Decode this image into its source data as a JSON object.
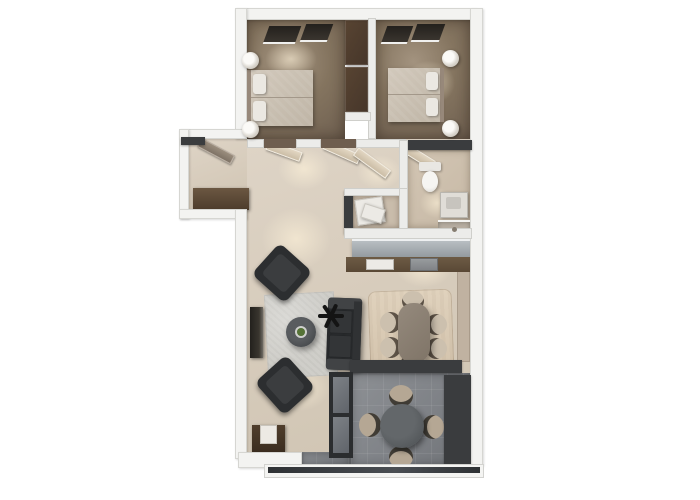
{
  "meta": {
    "description": "Top-down 3D rendered floor plan of a two-bedroom apartment with balcony",
    "background_color": "#ffffff",
    "visible_text": "none"
  },
  "palette": {
    "exterior_wall": "#f3f3f1",
    "dark_wall": "#3a3c3e",
    "bedroom_floor": "#84745f",
    "living_floor": "#d7ccbc",
    "bathroom_floor": "#c6b8a5",
    "balcony_floor": "#7f8287",
    "wardrobe_brown": "#46362a",
    "sofa_charcoal": "#27292b",
    "dining_rug": "#d3c3ac",
    "chair_tan": "#ccc0ae",
    "accent_plant_green": "#557336"
  },
  "rooms": {
    "bedroom1": {
      "label": "Bedroom 1 (left)"
    },
    "bedroom2": {
      "label": "Bedroom 2 (right)"
    },
    "hallway": {
      "label": "Hallway"
    },
    "entry": {
      "label": "Entry"
    },
    "bathroom": {
      "label": "Bathroom"
    },
    "storage": {
      "label": "Storage closet"
    },
    "kitchen": {
      "label": "Kitchen counter"
    },
    "living": {
      "label": "Living room"
    },
    "dining": {
      "label": "Dining area"
    },
    "balcony": {
      "label": "Balcony / terrace"
    }
  },
  "furniture": {
    "bedroom1": {
      "bed": "Double bed with two pillows",
      "lamps": "Two bedside lamps",
      "windows": "Two windows on top wall",
      "wardrobe": "Dark wardrobe column"
    },
    "bedroom2": {
      "bed": "Double bed with two pillows",
      "lamps": "Two bedside lamps",
      "windows": "Two windows on top wall"
    },
    "bathroom": {
      "toilet": "Toilet",
      "vanity": "Washbasin vanity",
      "shower": "Corner shower"
    },
    "storage": {
      "appliance": "White appliance / shelving"
    },
    "kitchen": {
      "island": "Grey kitchen unit",
      "counter": "Brown countertop",
      "sink": "Sink",
      "hob": "Cooktop"
    },
    "living": {
      "sofa": "Charcoal sofa",
      "armchairs": "Two dark armchairs",
      "coffee_table": "Round coffee table with plant",
      "rug": "Light grey rug",
      "tv_console": "Media sideboard",
      "side_cabinet": "Cabinet with lamp",
      "floor_plant": "Black decorative plant"
    },
    "dining": {
      "table": "Rectangular dining table",
      "chairs": "Six tan chairs",
      "rug": "Beige area rug"
    },
    "entry": {
      "console": "Entry console",
      "door": "Entrance door"
    },
    "balcony": {
      "table": "Round outdoor table",
      "chairs": "Four outdoor chairs",
      "railing": "Glass railing",
      "screen": "Dark privacy screen"
    }
  }
}
